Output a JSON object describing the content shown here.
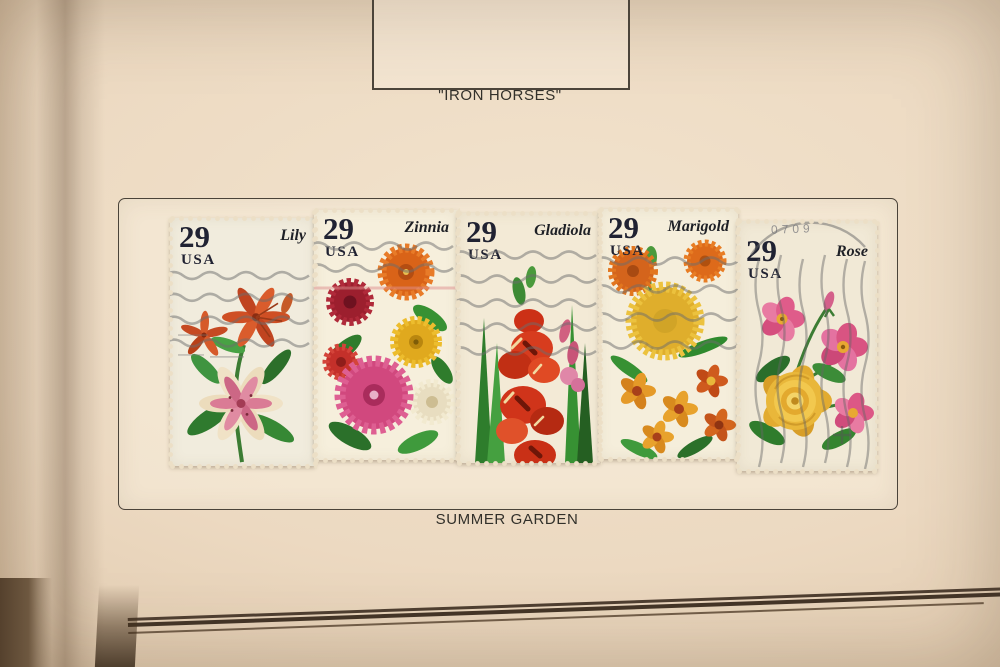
{
  "page": {
    "top_caption": "\"IRON HORSES\"",
    "bottom_caption": "SUMMER GARDEN"
  },
  "stamps": [
    {
      "title": "Lily",
      "denomination": "29",
      "country": "USA"
    },
    {
      "title": "Zinnia",
      "denomination": "29",
      "country": "USA"
    },
    {
      "title": "Gladiola",
      "denomination": "29",
      "country": "USA"
    },
    {
      "title": "Marigold",
      "denomination": "29",
      "country": "USA"
    },
    {
      "title": "Rose",
      "denomination": "29",
      "country": "USA"
    }
  ],
  "postmark": {
    "rose_fragment": "0709"
  },
  "colors": {
    "album_page": "#ecd9c1",
    "frame_line": "#4a4339",
    "caption_text": "#32302a",
    "stamp_paper": "#f3ecda",
    "denomination_ink": "#202232",
    "cancellation_gray": "#6d6d6d"
  }
}
